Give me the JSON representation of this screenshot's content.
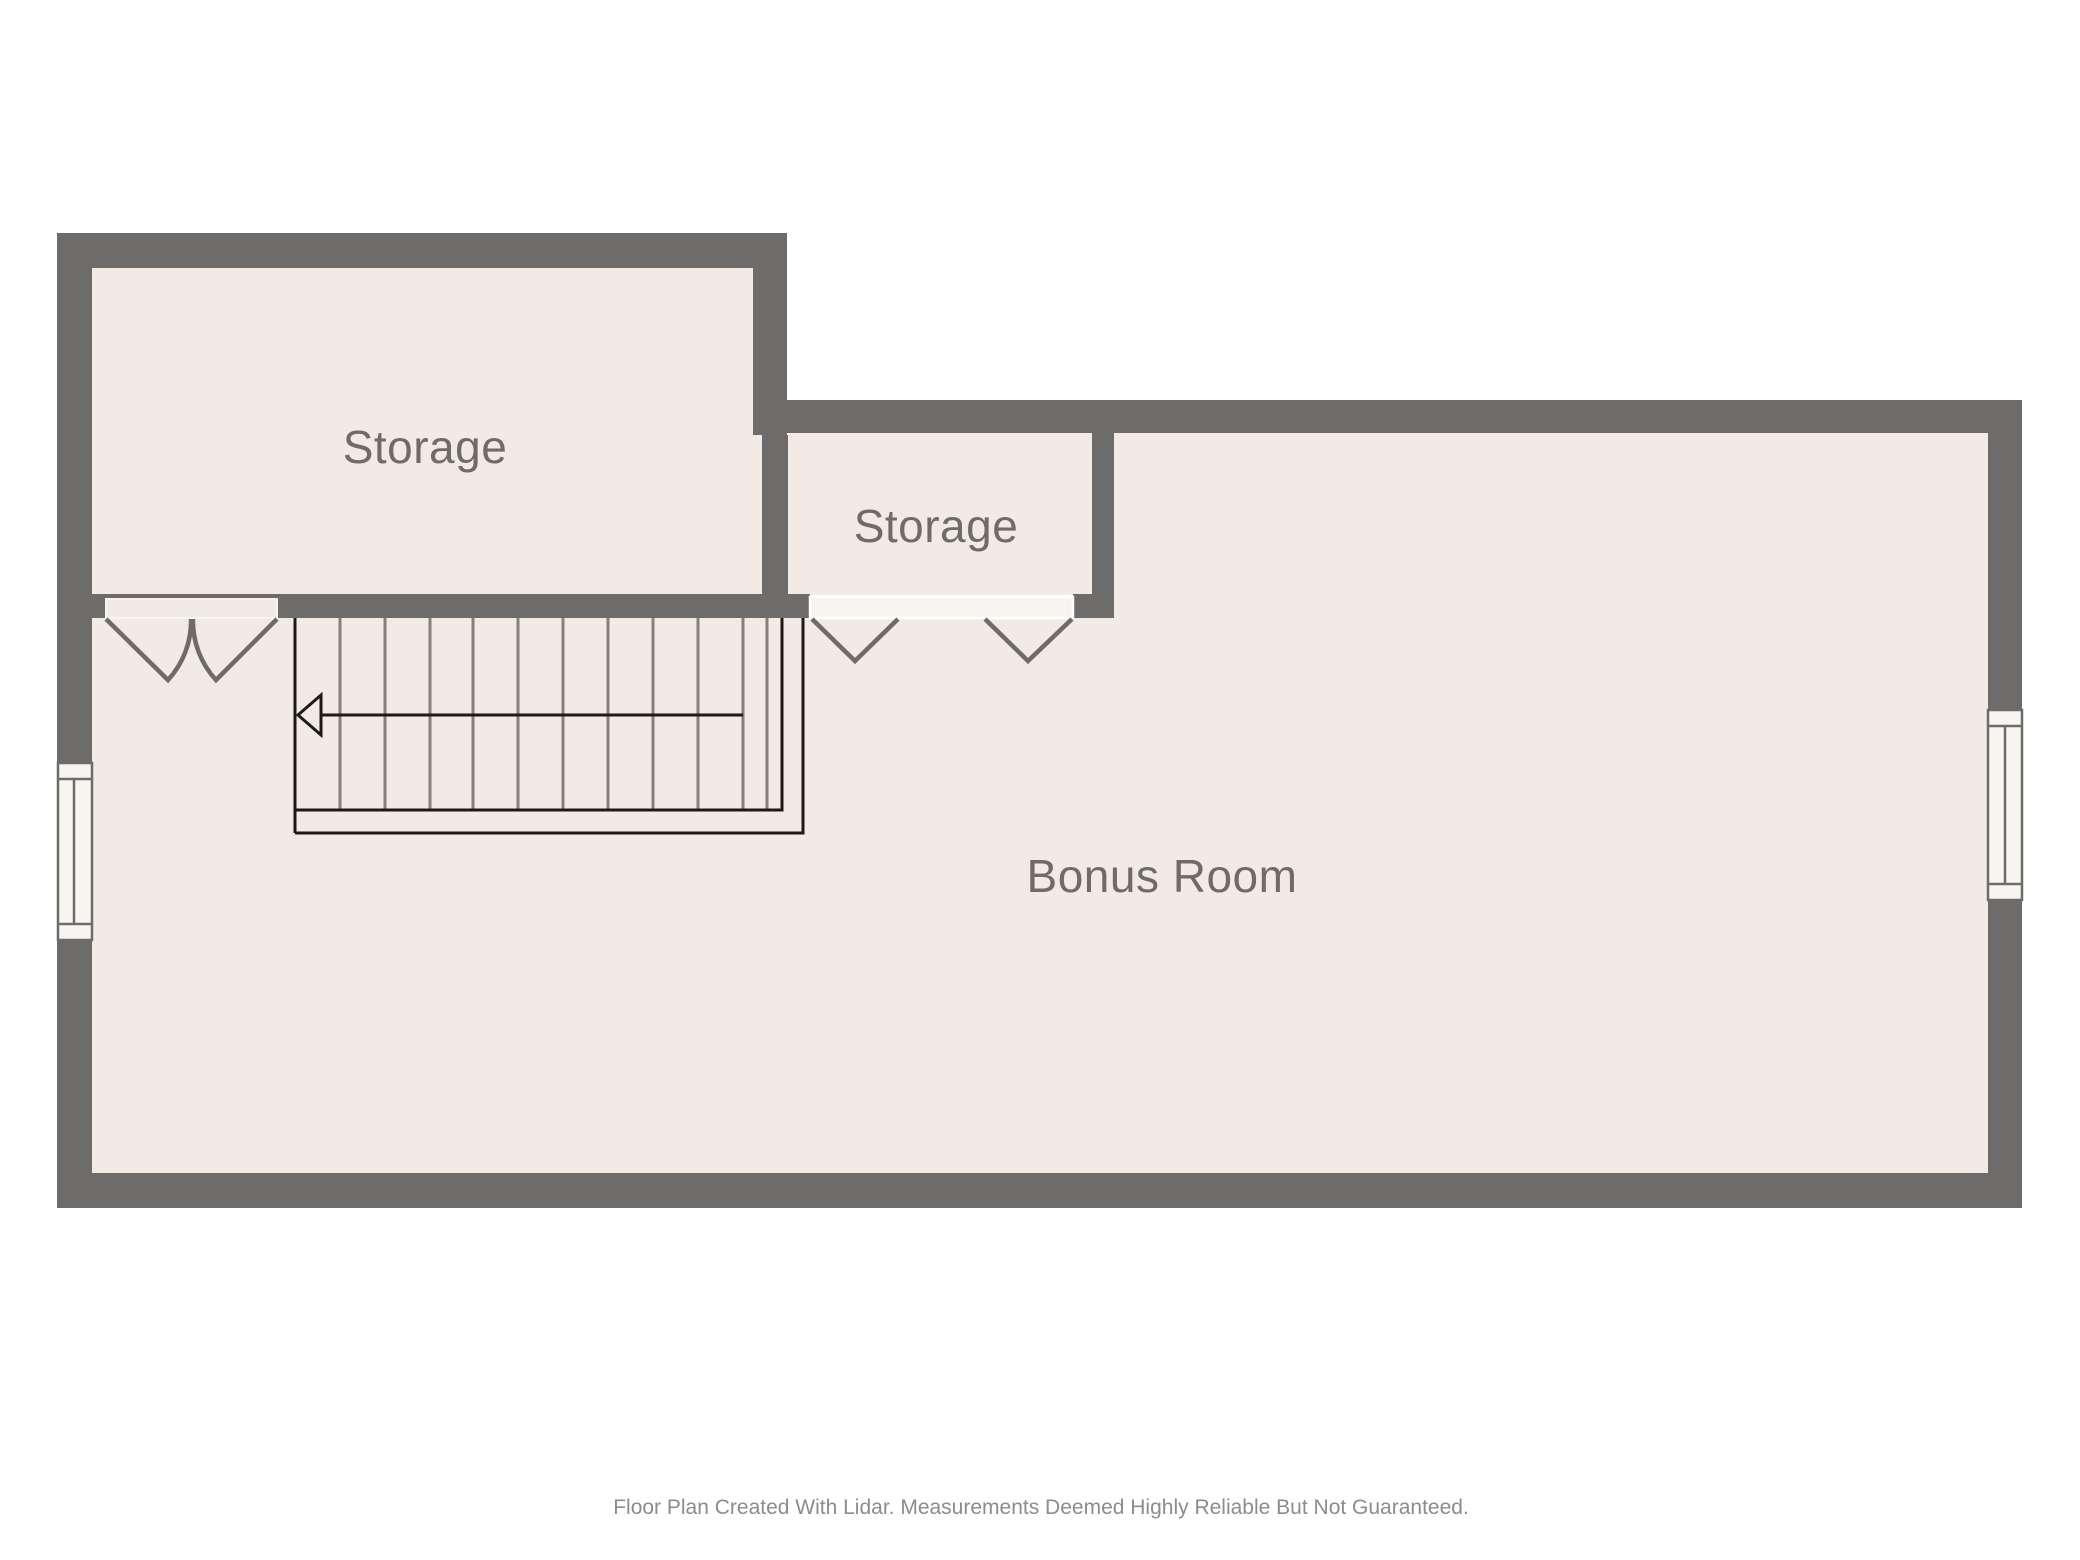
{
  "rooms": [
    {
      "id": "storage-1",
      "label": "Storage"
    },
    {
      "id": "storage-2",
      "label": "Storage"
    },
    {
      "id": "bonus-room",
      "label": "Bonus Room"
    }
  ],
  "footer": {
    "disclaimer": "Floor Plan Created With Lidar. Measurements Deemed Highly Reliable But Not Guaranteed."
  },
  "colors": {
    "background": "#ffffff",
    "wall": "#6d6c6a",
    "floor": "#f2ebe5",
    "threshold_light": "#f8f5f1",
    "door_stroke": "#6e6b68",
    "stair_line": "#83807d",
    "stair_outline": "#1d1b1a",
    "label_text": "#6f6b67",
    "footer_text": "#8c8c8c"
  }
}
